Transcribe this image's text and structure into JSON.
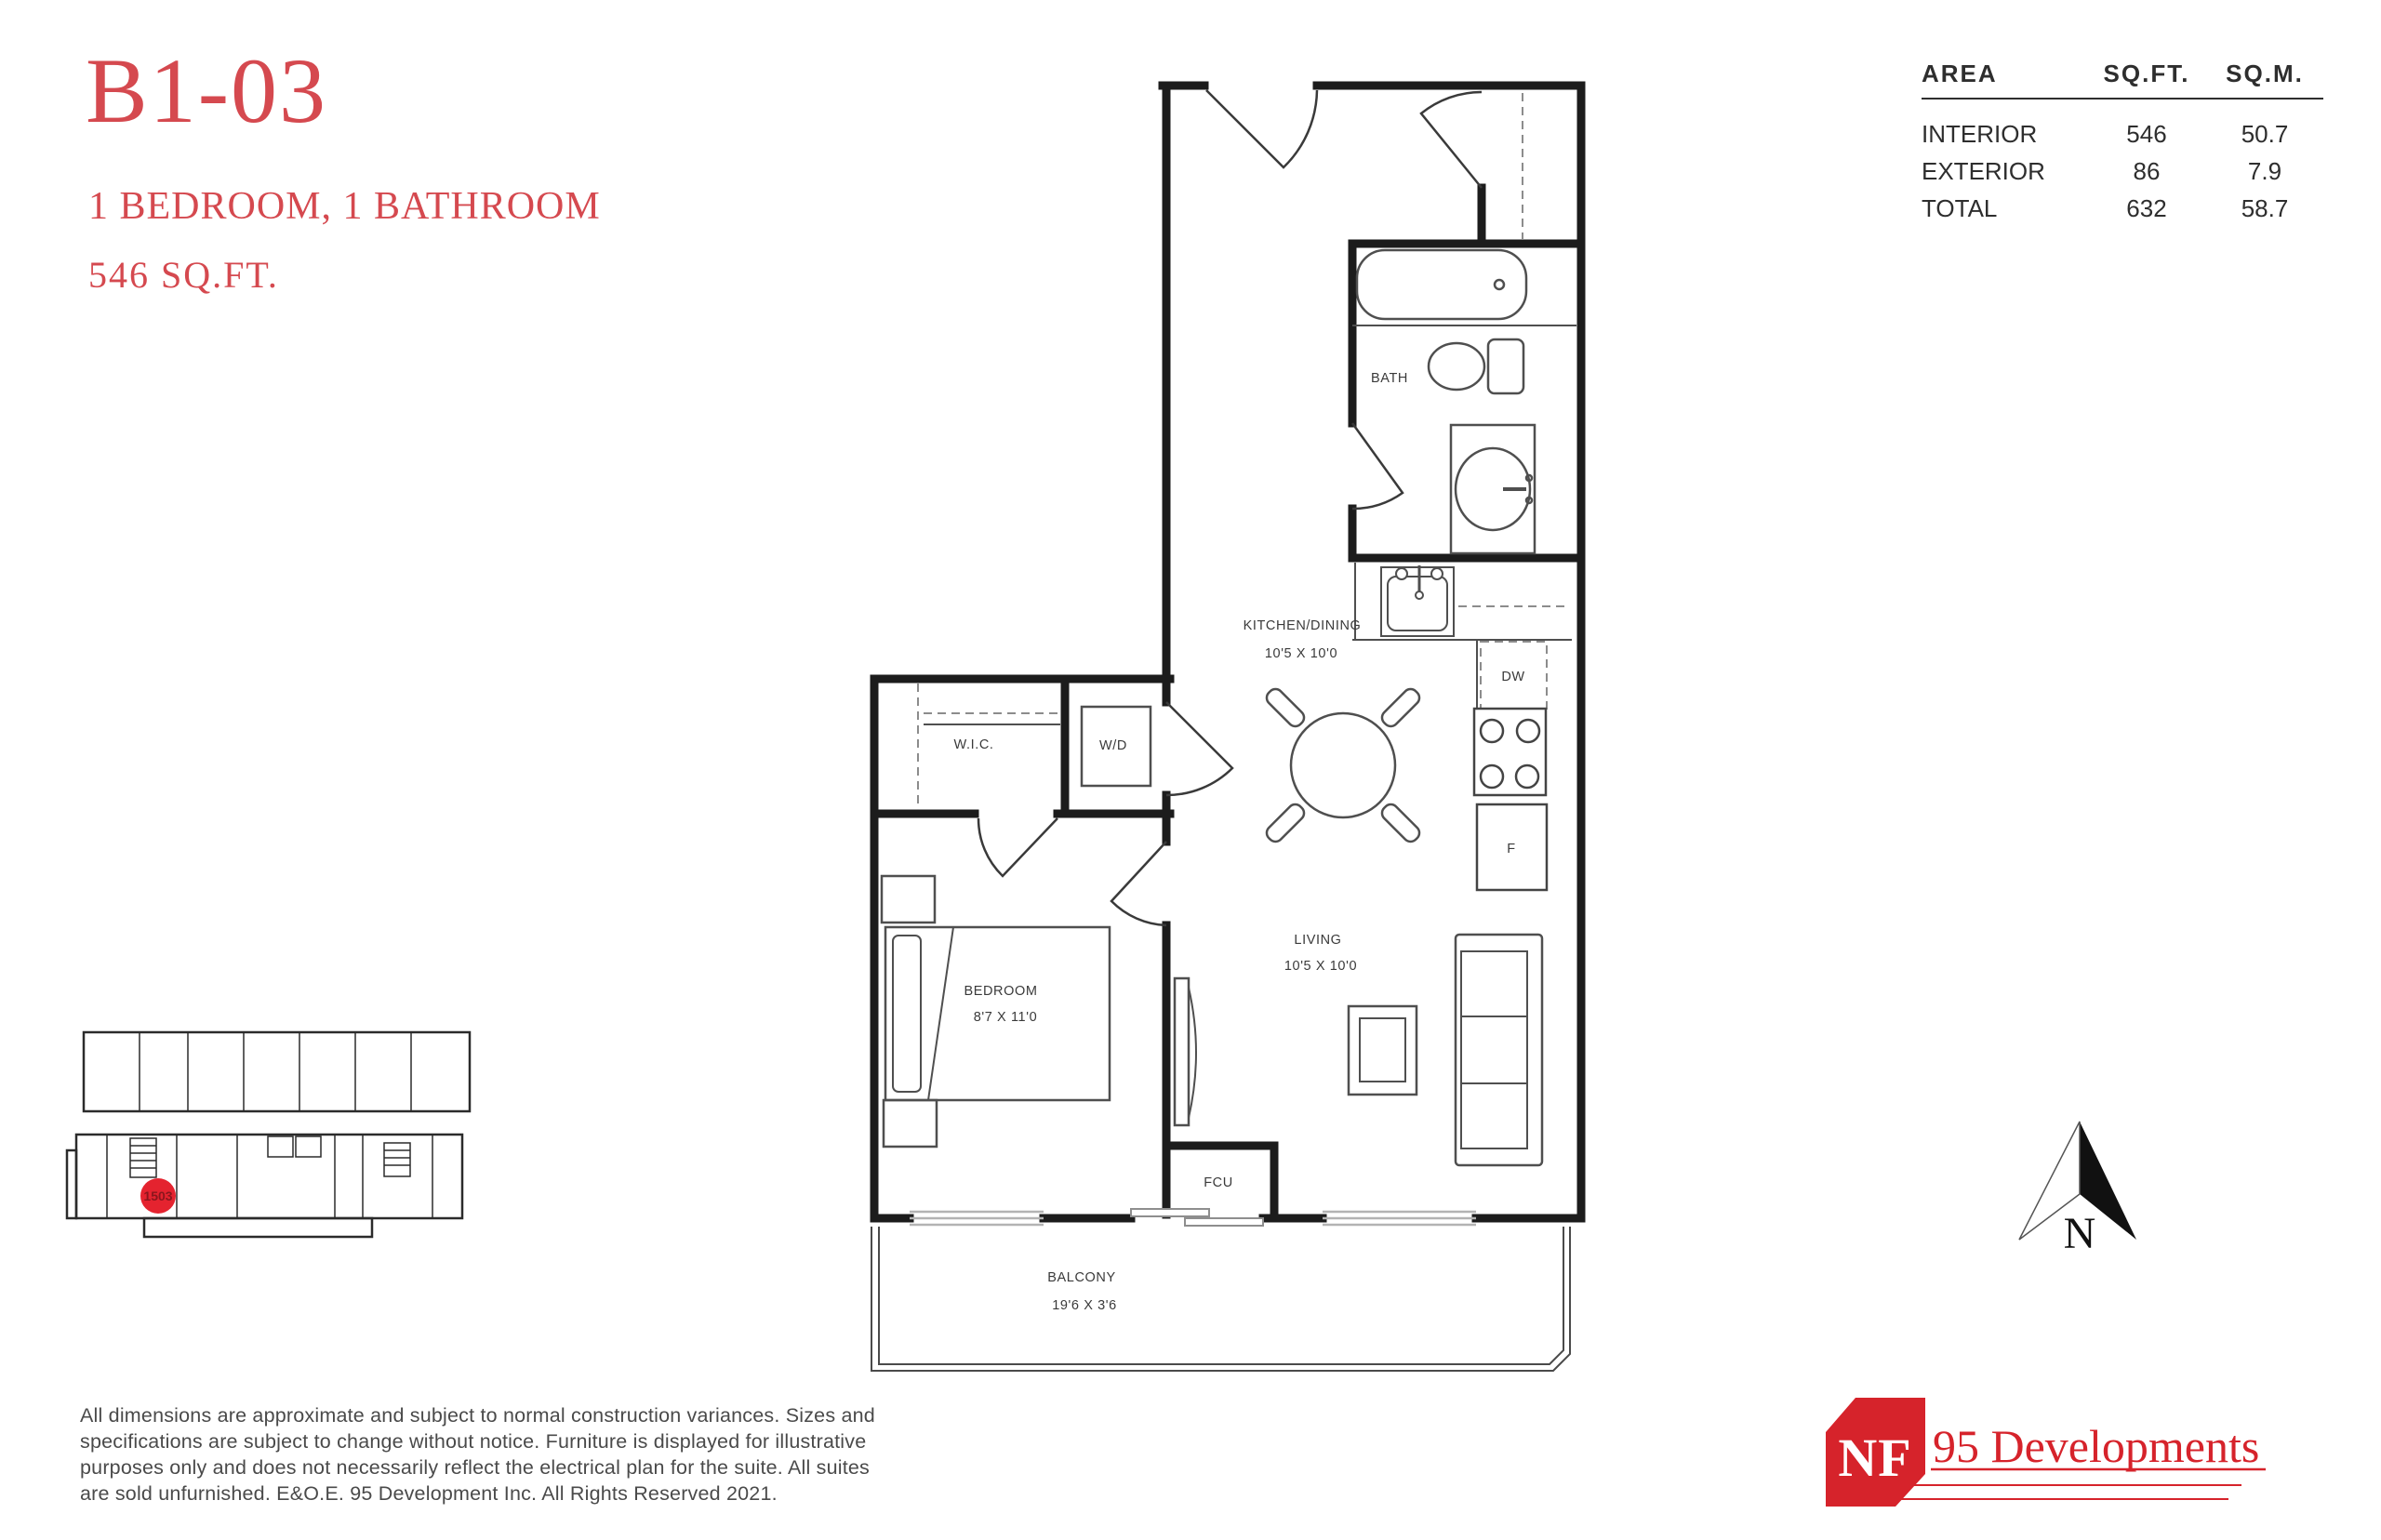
{
  "unit": {
    "code": "B1-03",
    "type": "1 BEDROOM, 1 BATHROOM",
    "area": "546 SQ.FT."
  },
  "area_table": {
    "headers": [
      "AREA",
      "SQ.FT.",
      "SQ.M."
    ],
    "rows": [
      {
        "label": "INTERIOR",
        "sqft": "546",
        "sqm": "50.7"
      },
      {
        "label": "EXTERIOR",
        "sqft": "86",
        "sqm": "7.9"
      },
      {
        "label": "TOTAL",
        "sqft": "632",
        "sqm": "58.7"
      }
    ]
  },
  "floor_plan": {
    "labels": {
      "bath": "BATH",
      "kitchen": "KITCHEN/DINING",
      "kitchen_dims": "10'5 X 10'0",
      "wic": "W.I.C.",
      "wd": "W/D",
      "dw": "DW",
      "fridge": "F",
      "fcu": "FCU",
      "bedroom": "BEDROOM",
      "bedroom_dims": "8'7 X 11'0",
      "living": "LIVING",
      "living_dims": "10'5 X 10'0",
      "balcony": "BALCONY",
      "balcony_dims": "19'6 X 3'6"
    }
  },
  "key_plan": {
    "unit_number": "1503"
  },
  "north_label": "N",
  "disclaimer": {
    "lines": [
      "All dimensions are approximate and subject to normal construction variances.  Sizes and",
      "specifications are subject to change without notice. Furniture is displayed for illustrative",
      "purposes only and does not necessarily reflect the electrical plan for the suite. All suites",
      "are sold unfurnished. E&O.E. 95 Development Inc. All Rights Reserved 2021."
    ]
  },
  "logo": {
    "badge": "NF",
    "name": "95 Developments"
  },
  "colors": {
    "accent_red": "#d5494f",
    "logo_red": "#d6232b",
    "marker_red": "#e4232f",
    "plan_line": "#1c1c1c",
    "window_gray": "#b3b3b3"
  }
}
